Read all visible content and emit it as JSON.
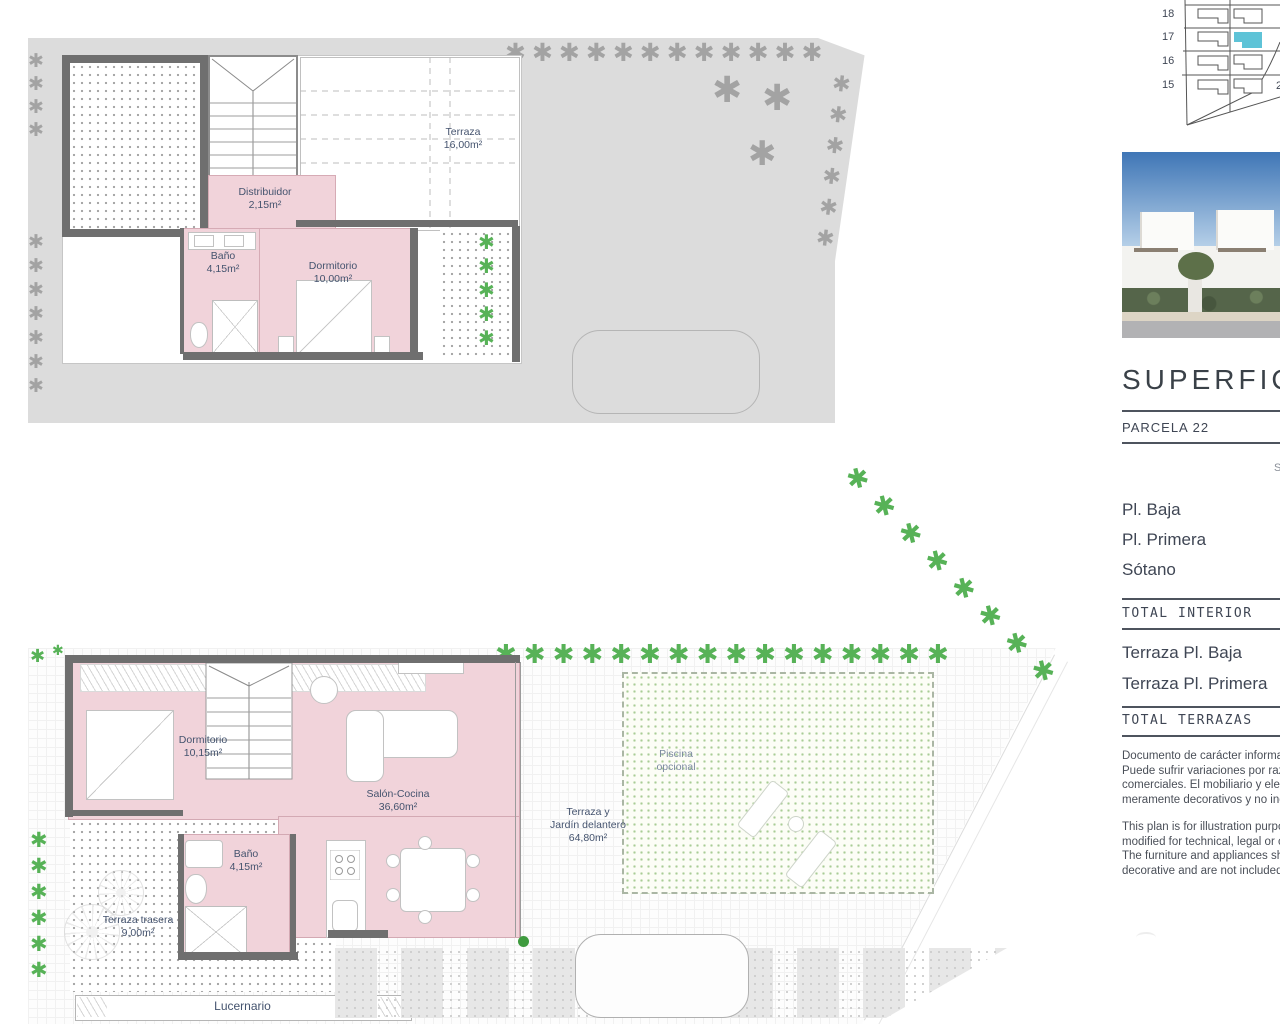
{
  "colors": {
    "accent": "#5ec3d7",
    "room_pink": "#f1d3da",
    "wall": "#6f6f6f",
    "tree_green": "#57b257",
    "tree_gray": "#a3a3a3",
    "label_navy": "#44536e"
  },
  "upper_plan": {
    "terraza": {
      "name": "Terraza",
      "area": "16,00m²"
    },
    "distribuidor": {
      "name": "Distribuidor",
      "area": "2,15m²"
    },
    "bano": {
      "name": "Baño",
      "area": "4,15m²"
    },
    "dormitorio": {
      "name": "Dormitorio",
      "area": "10,00m²"
    }
  },
  "lower_plan": {
    "dormitorio": {
      "name": "Dormitorio",
      "area": "10,15m²"
    },
    "salon": {
      "name": "Salón-Cocina",
      "area": "36,60m²"
    },
    "bano": {
      "name": "Baño",
      "area": "4,15m²"
    },
    "terraza_trasera": {
      "name": "Terraza trasera",
      "area": "9,00m²"
    },
    "jardin": {
      "line1": "Terraza y",
      "line2": "Jardín delantero",
      "area": "64,80m²"
    },
    "piscina": {
      "line1": "Piscina",
      "line2": "opcional"
    },
    "lucernario": "Lucernario"
  },
  "sidebar": {
    "site_plan": {
      "row_labels": [
        "18",
        "17",
        "16",
        "15"
      ],
      "edge_fragment": "2"
    },
    "heading": "SUPERFICI",
    "parcela": "PARCELA 22",
    "column_fragment": "S",
    "floors": [
      "Pl. Baja",
      "Pl. Primera",
      "Sótano"
    ],
    "total_interior": "TOTAL INTERIOR",
    "terraces": [
      "Terraza Pl. Baja",
      "Terraza Pl. Primera"
    ],
    "total_terrazas": "TOTAL TERRAZAS",
    "disclaimer_es": [
      "Documento de carácter informat",
      "Puede sufrir variaciones por razo",
      "comerciales. El mobiliario y elect",
      "meramente decorativos y no incl"
    ],
    "disclaimer_en": [
      "This plan is for illustration purpos",
      "modified for technical, legal or co",
      "The furniture and appliances sho",
      "decorative and are not included."
    ]
  }
}
